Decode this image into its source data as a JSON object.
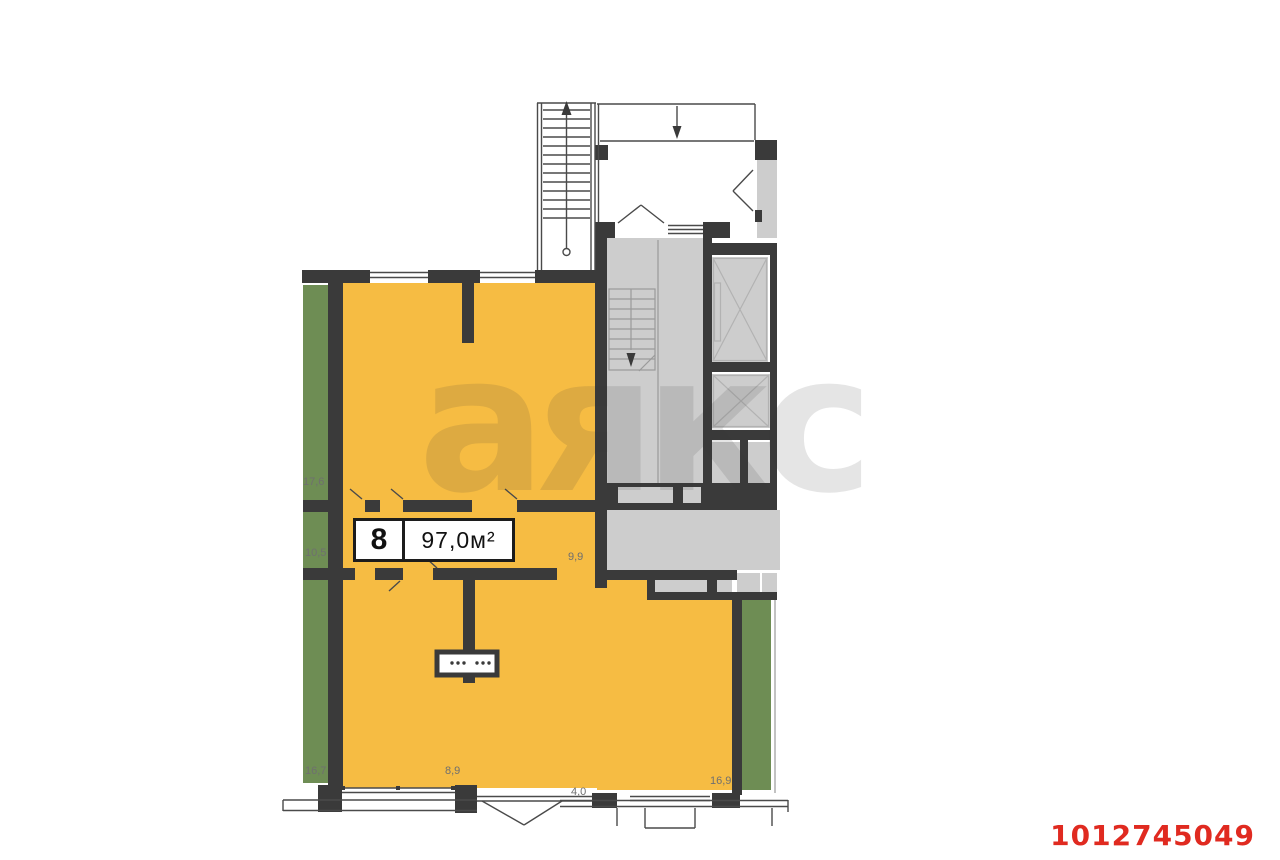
{
  "floorplan": {
    "unit": {
      "number": "8",
      "area": "97,0м²"
    },
    "dimensions": [
      {
        "value": "17,6"
      },
      {
        "value": "10,5"
      },
      {
        "value": "16,7"
      },
      {
        "value": "8,9"
      },
      {
        "value": "4,0"
      },
      {
        "value": "16,9"
      },
      {
        "value": "9,9"
      }
    ],
    "watermark": "аякс",
    "listing_id": "1012745049",
    "colors": {
      "unit_fill": "#F6BC43",
      "neighbor_fill": "#6E8D54",
      "common_fill": "#CDCDCD",
      "wall": "#3A3A3A",
      "id_red": "#E02A20"
    }
  }
}
